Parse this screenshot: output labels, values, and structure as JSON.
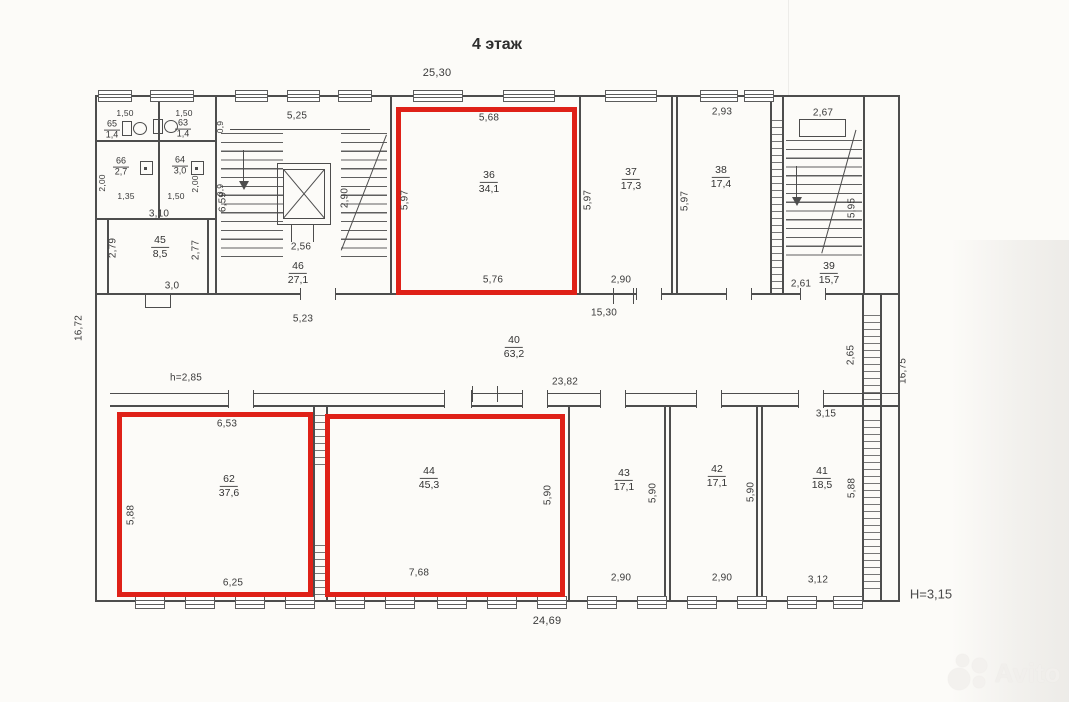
{
  "title": "4 этаж",
  "plan": {
    "overall": {
      "top": "25,30",
      "bottom": "24,69",
      "left": "16,72",
      "right": "16,75",
      "height": "Н=3,15",
      "clear_height": "h=2,85"
    },
    "rooms": {
      "r65": {
        "num": "65",
        "area": "1,4",
        "top": "1,50"
      },
      "r63": {
        "num": "63",
        "area": "1,4",
        "top": "1,50",
        "door": "0,9"
      },
      "r66": {
        "num": "66",
        "area": "2,7",
        "bottom": "1,35",
        "side": "2,00"
      },
      "r64": {
        "num": "64",
        "area": "3,0",
        "bottom": "1,50",
        "side": "2,00",
        "door": "0,9"
      },
      "r45": {
        "num": "45",
        "area": "8,5",
        "top": "3,10",
        "left": "2,79",
        "right": "2,77",
        "bottom": "3,0"
      },
      "r46": {
        "num": "46",
        "area": "27,1",
        "top": "5,25",
        "left": "6,59",
        "lift_side": "2,90",
        "lift_width": "2,56"
      },
      "r36": {
        "num": "36",
        "area": "34,1",
        "top": "5,68",
        "left": "5,97",
        "bottom": "5,76",
        "highlighted": true
      },
      "r37": {
        "num": "37",
        "area": "17,3",
        "left": "5,97",
        "bottom": "2,90"
      },
      "r38": {
        "num": "38",
        "area": "17,4",
        "top": "2,93",
        "left": "5,97"
      },
      "r39": {
        "num": "39",
        "area": "15,7",
        "top": "2,67",
        "side": "5,95",
        "bottom": "2,61"
      },
      "r40": {
        "num": "40",
        "area": "63,2",
        "top": "15,30",
        "bottom": "23,82",
        "left": "5,23",
        "right": "2,65"
      },
      "r62": {
        "num": "62",
        "area": "37,6",
        "top": "6,53",
        "left": "5,88",
        "bottom": "6,25",
        "highlighted": true
      },
      "r44": {
        "num": "44",
        "area": "45,3",
        "right": "5,90",
        "bottom": "7,68",
        "highlighted": true
      },
      "r43": {
        "num": "43",
        "area": "17,1",
        "side": "5,90",
        "bottom": "2,90"
      },
      "r42": {
        "num": "42",
        "area": "17,1",
        "side": "5,90",
        "bottom": "2,90"
      },
      "r41": {
        "num": "41",
        "area": "18,5",
        "top": "3,15",
        "right": "5,88",
        "bottom": "3,12"
      }
    }
  },
  "colors": {
    "highlight": "#df2118",
    "line": "#4d4d4d",
    "paper": "#fcfbf8"
  },
  "watermark": {
    "brand": "Avito"
  }
}
